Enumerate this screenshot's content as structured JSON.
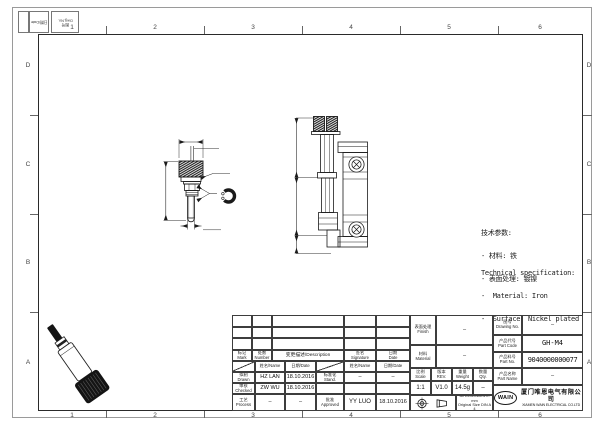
{
  "sheet": {
    "zone_numbers_top": [
      "1",
      "2",
      "3",
      "4",
      "5",
      "6"
    ],
    "zone_numbers_bottom": [
      "1",
      "2",
      "3",
      "4",
      "5",
      "6"
    ],
    "zone_letters_left": [
      "D",
      "C",
      "B",
      "A"
    ],
    "zone_letters_right": [
      "D",
      "C",
      "B",
      "A"
    ],
    "corner_cells": {
      "date": "日期/Date",
      "dwg_no": "图号\nDwg.No."
    }
  },
  "drawing": {
    "front_view": {
      "dia_head": "ø12",
      "slot_width": "1.8",
      "dia_collar": "ø7",
      "total_length": "41.7",
      "thread": "M4"
    },
    "side_view": {
      "dim_top": "30",
      "dim_mid": "19.5",
      "dim_bottom": "6.8"
    }
  },
  "tech_spec": {
    "cn_title": "技术参数:",
    "cn_material": "- 材料: 铁",
    "cn_surface": "- 表面处理: 镀镍",
    "en_title": "Technical specification:",
    "en_material": "-  Material: Iron",
    "en_surface": "-  Surface: Nickel plated"
  },
  "title_block": {
    "revision_header": {
      "mark": "标记\nMark",
      "number": "处数\nNumber",
      "description": "变更描述/Description",
      "signature": "签名\nSignature",
      "date": "日期\nDate"
    },
    "name_date_header": {
      "name": "姓名/Name",
      "date": "日期/Date",
      "name2": "姓名/Name",
      "date2": "日期/Date"
    },
    "sign_rows": [
      {
        "label": "拟制\nDrawn",
        "name": "HZ LAN",
        "date": "18.10.2016",
        "label2": "标准化\nStand.",
        "name2": "–",
        "date2": "–"
      },
      {
        "label": "审核\nChecked",
        "name": "ZW WU",
        "date": "18.10.2016",
        "label2": "",
        "name2": "",
        "date2": ""
      },
      {
        "label": "工艺\nProcess",
        "name": "–",
        "date": "–",
        "label2": "批准\nApproved",
        "name2": "YY LUO",
        "date2": "18.10.2016"
      }
    ],
    "finish_label": "表面处理\nFinish",
    "finish_value": "–",
    "material_label": "材料\nMaterial",
    "material_value": "–",
    "scale_label": "比例\nScale",
    "scale_value": "1:1",
    "rev_label": "版本\nREV.",
    "rev_value": "V1.0",
    "weight_label": "重量\nWeight",
    "weight_value": "14.5g",
    "qty_label": "数量\nQty.",
    "qty_value": "–",
    "drawing_no_label": "图号\nDrawing No.",
    "drawing_no_value": "–",
    "part_code_label": "产品代号\nPart Code",
    "part_code_value": "GH-M4",
    "part_no_label": "产品料号\nPart No.",
    "part_no_value": "9040000000077",
    "part_name_label": "产品名称\nPart Name",
    "part_name_value": "–",
    "dims_note": "All Dimensions in mm\nOriginal Size DIN A 4",
    "logo_text": "WAIN",
    "company_cn": "厦门唯恩电气有限公司",
    "company_en": "XIAMEN WAIN ELECTRICAL CO.LTD"
  },
  "colors": {
    "line": "#1a1a1a",
    "frame": "#2a2a2a",
    "paper": "#ffffff"
  }
}
